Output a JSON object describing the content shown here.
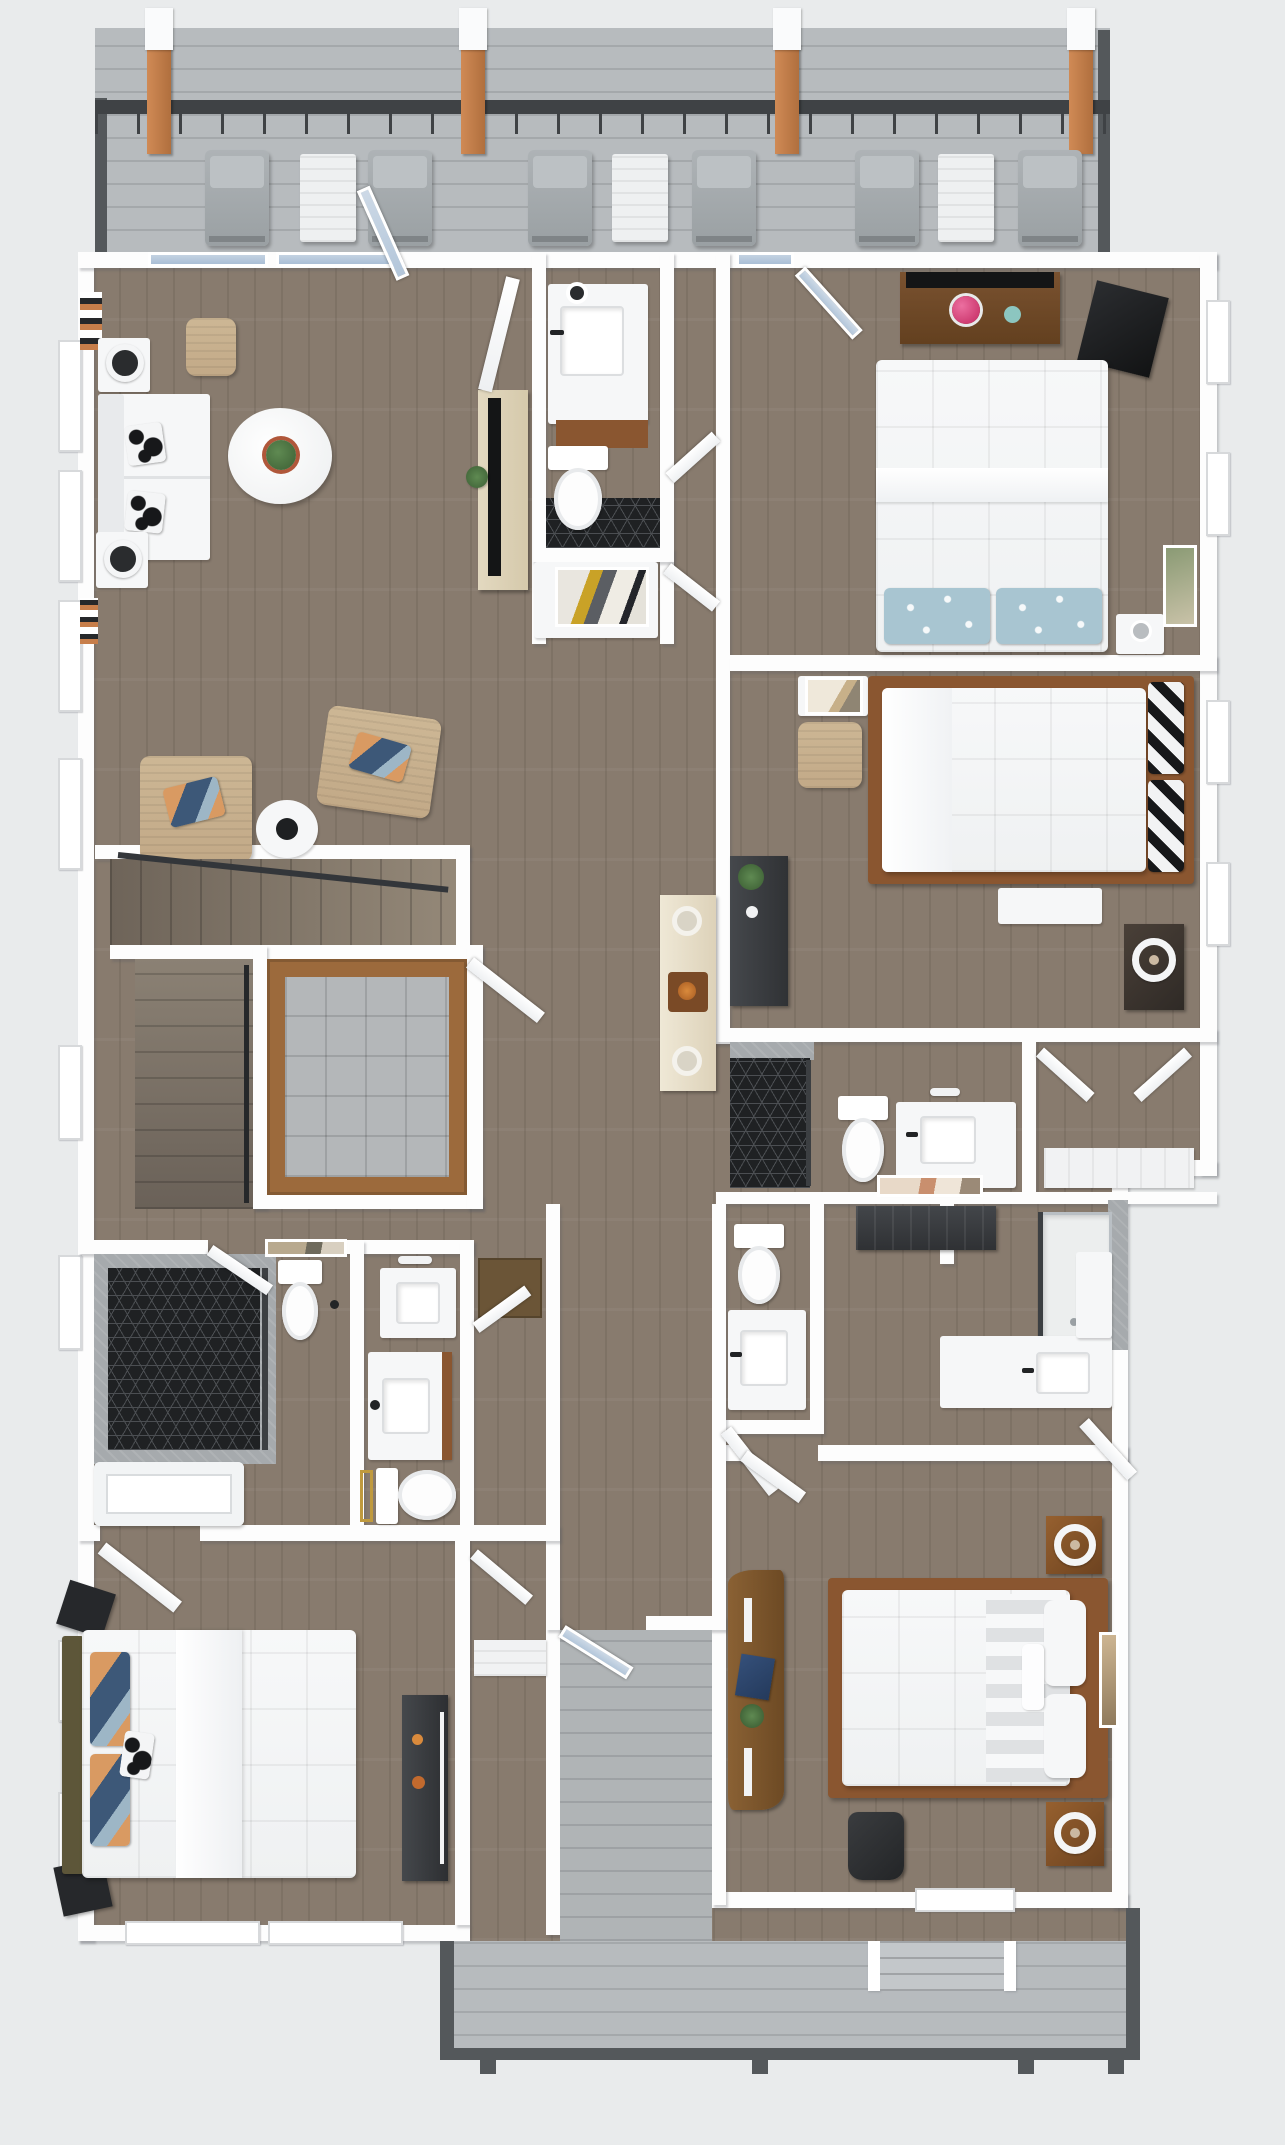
{
  "meta": {
    "title": "3D Floor Plan Rendering - Top-Down Dollhouse View",
    "view": "top-down 3D render",
    "visible_text": "none"
  },
  "colors": {
    "background": "#e9ebec",
    "wall": "#fdfdfd",
    "wood_floor": "#887b6e",
    "deck_boards": "#b7bbbe",
    "deck_frame": "#54585b",
    "railing": "#3f4245",
    "pergola_post": "#c07c49",
    "glass": "#b9cadd",
    "hex_tile": "#1f2123",
    "stone": "#a6aaad",
    "gray_tile": "#b4b7b9",
    "closet_wood": "#9c6a3c",
    "upholstery_white": "#f6f7f8",
    "tan_fabric": "#cdb493",
    "navy_accent": "#3d5878",
    "bed_frame_brown": "#8a5630",
    "desk_walnut": "#6e4a2b",
    "charcoal_furniture": "#3a3d40",
    "tv_black": "#141516",
    "terracotta": "#b0573a",
    "plant_green": "#49703f",
    "flower_pink": "#d23b71",
    "teal_accent": "#8cc6c0",
    "gold_accent": "#c09a3e",
    "cream_console": "#e6decb",
    "olive_headboard": "#5d5639",
    "light_blue_pillow": "#a8c5d1"
  },
  "deck_top": {
    "lounge_chair_count": 6,
    "side_table_count": 3,
    "pergola_post_count": 4,
    "post_x": [
      147,
      461,
      775,
      1069
    ],
    "lounger_x": [
      205,
      368,
      528,
      692,
      855,
      1018
    ],
    "table_x": [
      300,
      612,
      938
    ],
    "items": [
      "railing",
      "pergola posts with white caps",
      "lounge chairs",
      "white slat side tables"
    ]
  },
  "rooms": [
    {
      "name": "top-deck",
      "furniture": [
        "6 lounge chairs",
        "3 white side tables",
        "metal railing",
        "4 wood pergola posts"
      ]
    },
    {
      "name": "living-room",
      "furniture": [
        "white sofa",
        "2 black-white pillows",
        "2 side tables with globe lamps",
        "tan pouf",
        "round white marble table with potted plant",
        "2 tan armchairs with navy pillows",
        "small round side table",
        "light-wood media console with TV",
        "plant stand",
        "bookshelves"
      ]
    },
    {
      "name": "powder-bath-top",
      "furniture": [
        "vanity with sink and wood cabinet",
        "towel ring",
        "toilet",
        "black hex tile floor",
        "console with abstract art"
      ]
    },
    {
      "name": "bedroom-1-top-right",
      "furniture": [
        "walnut desk with TV",
        "pink flowers",
        "teal cup",
        "wall-mounted TV",
        "queen bed",
        "2 light blue floral pillows",
        "white nightstand",
        "framed art"
      ]
    },
    {
      "name": "bedroom-2-right",
      "furniture": [
        "white nightstand with leaning art",
        "tan pouf",
        "wood-frame bed",
        "2 black-white striped pillows",
        "white foot bench",
        "charcoal dresser with plant",
        "brown nightstand with ring lamp"
      ]
    },
    {
      "name": "ensuite-bath",
      "furniture": [
        "black hex shower",
        "toilet",
        "white vanity with sink",
        "sconce"
      ]
    },
    {
      "name": "walk-in-closet-bed2",
      "furniture": [
        "white shelving",
        "double doors"
      ]
    },
    {
      "name": "half-bath-center",
      "furniture": [
        "toilet",
        "white vanity with sink"
      ]
    },
    {
      "name": "master-bath-right",
      "furniture": [
        "glass shower with white pan",
        "L-shaped white vanity with sink",
        "charcoal bench",
        "framed art"
      ]
    },
    {
      "name": "staircase",
      "furniture": [
        "upper flight",
        "lower flight",
        "black handrail"
      ]
    },
    {
      "name": "elevator-closet",
      "furniture": [
        "wood-lined walls",
        "gray tile floor"
      ]
    },
    {
      "name": "bath-left",
      "furniture": [
        "stone shower with black hex floor",
        "glass door",
        "toilet",
        "art above toilet",
        "white soaking tub"
      ]
    },
    {
      "name": "bath-middle",
      "furniture": [
        "vanity with sconce",
        "vanity with wood cabinet",
        "toilet",
        "gold framed mirror"
      ]
    },
    {
      "name": "bedroom-3-bottom-left",
      "furniture": [
        "bed with olive headboard",
        "boho navy-orange pillows",
        "cow-print pillow",
        "2 black hex nightstands",
        "charcoal media console with TV",
        "windows"
      ]
    },
    {
      "name": "master-bedroom-bottom-right",
      "furniture": [
        "live-edge wood desk",
        "navy laptop",
        "plant",
        "black office chair",
        "wood-frame bed",
        "gray striped blanket",
        "white pillows",
        "2 brown nightstands with ring lamps",
        "framed art"
      ]
    },
    {
      "name": "breezeway-walkway",
      "furniture": [
        "glazed door",
        "gray decking"
      ]
    },
    {
      "name": "bottom-porch",
      "furniture": [
        "gray decking",
        "dark rim joists",
        "entry steps",
        "posts"
      ]
    }
  ]
}
